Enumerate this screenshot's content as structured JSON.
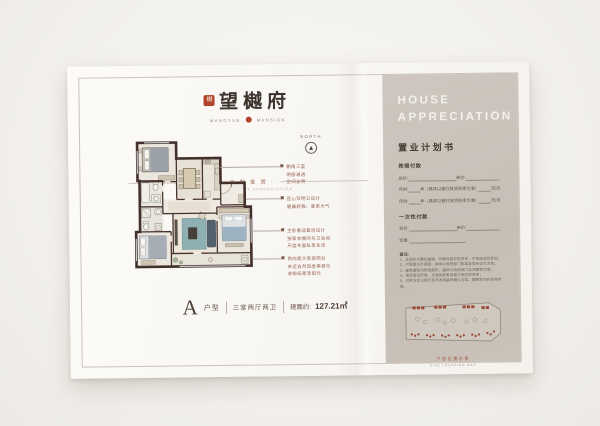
{
  "brand": {
    "seal_glyph": "樾",
    "name": "望樾府",
    "sub_left": "WANGYUE",
    "sub_right": "MANSION",
    "tagline": "· 户 型 鉴 赏 ·",
    "tagline_en": "REFINED LAYOUT APPRECIATION"
  },
  "north_label": "NORTH",
  "annotations": [
    {
      "lines": [
        "朝南三室",
        "明厨通透",
        "空间全明"
      ]
    },
    {
      "lines": [
        "匠心双明卫设计",
        "健康舒雅、尊贵大气",
        ""
      ]
    },
    {
      "lines": [
        "主卧奢适套房设计",
        "独享衣帽间与卫浴间",
        "尺度丰盈私享生活"
      ]
    },
    {
      "lines": [
        "南向超大观景阳台",
        "亲近自然四季美景尽",
        "收眼底尊享阳光"
      ]
    }
  ],
  "type_label": {
    "letter": "A",
    "word": "户型",
    "rooms": "三室两厅两卫",
    "area_label": "建面约:",
    "area_value": "127.21㎡"
  },
  "panel": {
    "title_line1": "HOUSE",
    "title_line2": "APPRECIATION",
    "subtitle": "置业计划书",
    "mortgage": {
      "heading": "按揭付款",
      "row1_a": "总价:",
      "row1_b": "单价:",
      "row2_a": "月供:",
      "row2_b": "年（具体以银行放贷利率为准）",
      "row2_c": "元/月",
      "row3_a": "月供:",
      "row3_b": "年（具体以银行放贷利率为准）",
      "row3_c": "元/月"
    },
    "onetime": {
      "heading": "一次性付款",
      "row1_a": "总价:",
      "row1_b": "单价:",
      "row2_a": "优惠:"
    },
    "notes_title": "备注:",
    "notes": [
      "1、本资料为要约邀请，所载内容仅供参考，不构成合同承诺；",
      "2、户型图为示意图，具体以规划部门批准及实际交付为准；",
      "3、建筑面积为预测面积，最终以政府部门实测面积为准；",
      "4、项目周边环境、交通及配套设施介绍仅供参考；",
      "5、付款方式以银行及开发商最终确认为准，解释权归开发商所有。"
    ],
    "siteplan_caption": "户型位置示意",
    "siteplan_caption_en": "SITE LOCATION MAP"
  }
}
